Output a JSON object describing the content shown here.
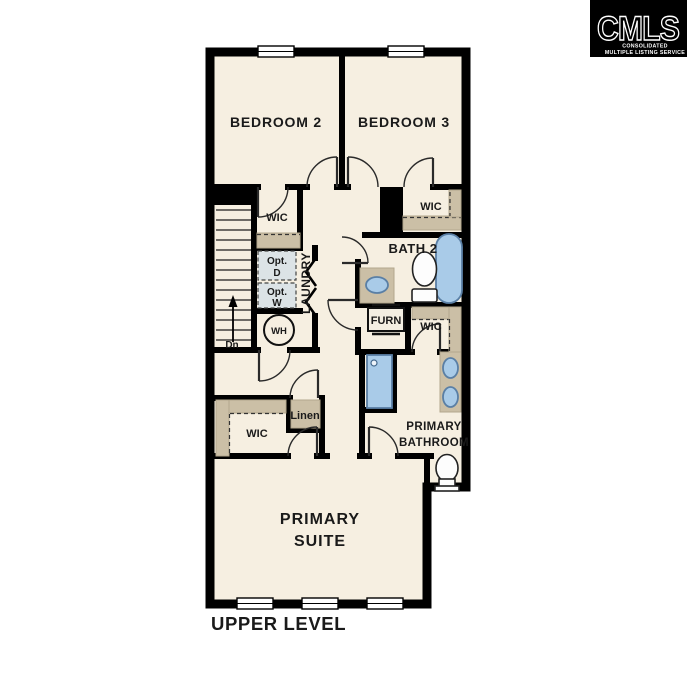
{
  "logo": {
    "brand": "CMLS",
    "tagline_line1": "CONSOLIDATED",
    "tagline_line2": "MULTIPLE LISTING SERVICE"
  },
  "floor_plan": {
    "level_title": "UPPER LEVEL",
    "rooms": {
      "bedroom2": "BEDROOM 2",
      "bedroom3": "BEDROOM 3",
      "bath2": "BATH 2",
      "laundry": "LAUNDRY",
      "primary_suite_line1": "PRIMARY",
      "primary_suite_line2": "SUITE",
      "primary_bathroom_line1": "PRIMARY",
      "primary_bathroom_line2": "BATHROOM"
    },
    "closets": {
      "wic_bedroom2": "WIC",
      "wic_bedroom3": "WIC",
      "wic_hall": "WIC",
      "wic_primary": "WIC",
      "linen": "Linen"
    },
    "utilities": {
      "furnace": "FURN",
      "water_heater": "WH",
      "opt_dryer_line1": "Opt.",
      "opt_dryer_line2": "D",
      "opt_washer_line1": "Opt.",
      "opt_washer_line2": "W"
    },
    "stairs": {
      "down_label": "Dn"
    }
  },
  "colors": {
    "background": "#ffffff",
    "floor": "#f6efe1",
    "wall": "#000000",
    "closet_shelf": "#cbbfa6",
    "fixture_fill": "#a9cbe8",
    "fixture_stroke": "#5a7fa5",
    "optional_appliance_fill": "#dce3e6",
    "logo_background": "#000000",
    "logo_foreground": "#ffffff",
    "label_text": "#1a1a1a"
  }
}
